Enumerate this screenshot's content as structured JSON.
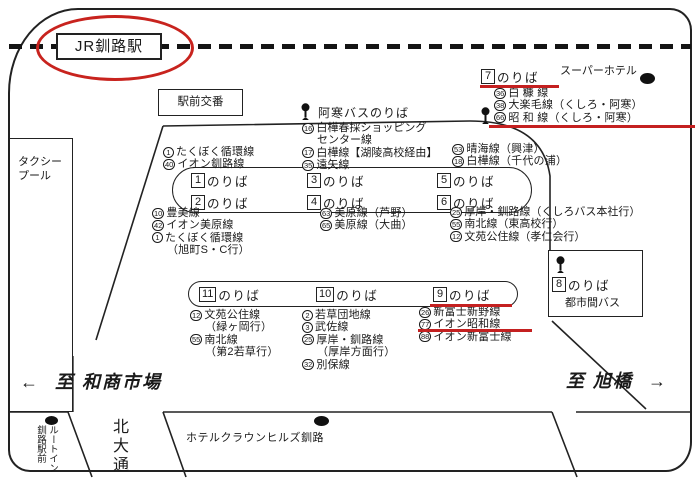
{
  "colors": {
    "ink": "#1a1a1a",
    "red": "#c42020"
  },
  "station_box": "JR釧路駅",
  "police_box": "駅前交番",
  "taxi_pool": "タクシープール",
  "akan_bus": "阿寒バスのりば",
  "super_hotel": "スーパーホテル",
  "noriba_suffix": "のりば",
  "stop7": {
    "num": "7",
    "routes": [
      {
        "num": "36",
        "name": "白 糠 線"
      },
      {
        "num": "38",
        "name": "大楽毛線（くしろ・阿寒）"
      },
      {
        "num": "66",
        "name": "昭 和 線（くしろ・阿寒）"
      }
    ]
  },
  "upper_left": [
    {
      "num": "1",
      "name": "たくぼく循環線"
    },
    {
      "num": "40",
      "name": "イオン釧路線"
    }
  ],
  "upper_mid": [
    {
      "num": "16",
      "name": "白樺春採ショッピング"
    },
    {
      "name": "センター線"
    },
    {
      "num": "17",
      "name": "白樺線【湖陵高校経由】"
    },
    {
      "num": "35",
      "name": "遠矢線"
    }
  ],
  "upper_right": [
    {
      "num": "53",
      "name": "晴海線（興津）"
    },
    {
      "num": "18",
      "name": "白樺線（千代の浦）"
    }
  ],
  "island_a": [
    "1",
    "3",
    "5",
    "2",
    "4",
    "6"
  ],
  "lower_left": [
    {
      "num": "10",
      "name": "豊美線"
    },
    {
      "num": "42",
      "name": "イオン美原線"
    },
    {
      "num": "1",
      "name": "たくぼく循環線"
    },
    {
      "name": "（旭町S・C行）"
    }
  ],
  "lower_mid": [
    {
      "num": "63",
      "name": "美原線（芦野）"
    },
    {
      "num": "65",
      "name": "美原線（大曲）"
    }
  ],
  "lower_right": [
    {
      "num": "25",
      "name": "厚岸・釧路線（くしろバス本社行）"
    },
    {
      "num": "55",
      "name": "南北線（東高校行）"
    },
    {
      "num": "12",
      "name": "文苑公住線（孝仁会行）"
    }
  ],
  "island_b": [
    "11",
    "10",
    "9"
  ],
  "stop11_routes": [
    {
      "num": "12",
      "name": "文苑公住線"
    },
    {
      "name": "（緑ヶ岡行）"
    },
    {
      "num": "55",
      "name": "南北線"
    },
    {
      "name": "（第2若草行）"
    }
  ],
  "stop10_routes": [
    {
      "num": "2",
      "name": "若草団地線"
    },
    {
      "num": "3",
      "name": "武佐線"
    },
    {
      "num": "25",
      "name": "厚岸・釧路線"
    },
    {
      "name": "（厚岸方面行）"
    },
    {
      "num": "32",
      "name": "別保線"
    }
  ],
  "stop9_routes": [
    {
      "num": "26",
      "name": "新富士新野線"
    },
    {
      "num": "77",
      "name": "イオン昭和線"
    },
    {
      "num": "88",
      "name": "イオン新富士線"
    }
  ],
  "stop8": {
    "num": "8",
    "label": "のりば",
    "sub": "都市間バス"
  },
  "dir_left": {
    "arrow": "←",
    "label": "至 和商市場"
  },
  "dir_right": {
    "label": "至 旭橋",
    "arrow": "→"
  },
  "route_inn": {
    "col1": "ルートイン",
    "col2": "釧路駅前"
  },
  "kita_odori": "北大通",
  "hotel_crown": "ホテルクラウンヒルズ釧路"
}
